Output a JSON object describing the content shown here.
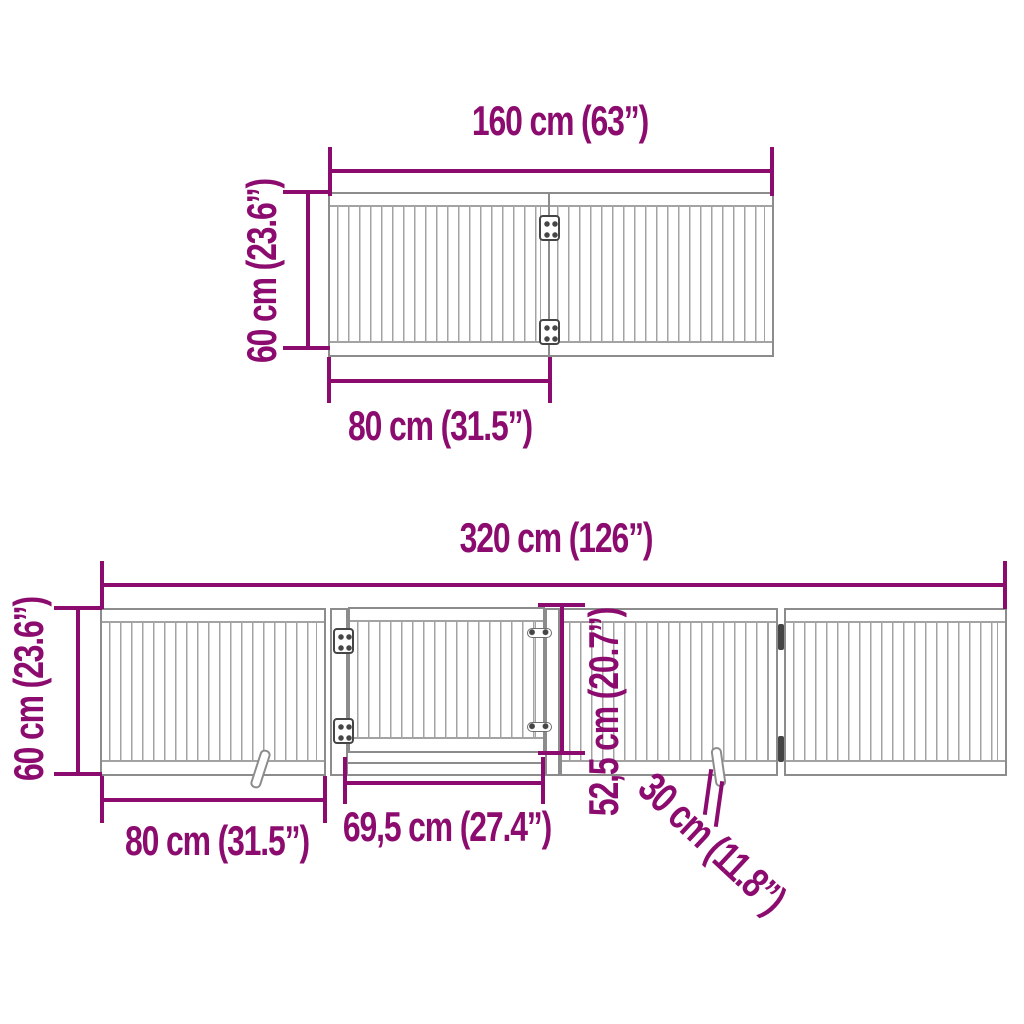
{
  "colors": {
    "accent": "#8C0B6E",
    "outline_gray": "#8c8c8c",
    "slat_gray": "#a3a3a3",
    "hinge_dark": "#454545",
    "background": "#ffffff"
  },
  "top_view": {
    "labels": {
      "total_width": "160 cm (63”)",
      "height": "60 cm (23.6”)",
      "panel_width": "80 cm (31.5”)"
    }
  },
  "bottom_view": {
    "labels": {
      "total_width": "320 cm (126”)",
      "height": "60 cm (23.6”)",
      "panel_width": "80 cm (31.5”)",
      "door_width": "69,5 cm (27.4”)",
      "door_height": "52,5 cm (20.7”)",
      "foot_length": "30 cm (11.8”)"
    }
  }
}
